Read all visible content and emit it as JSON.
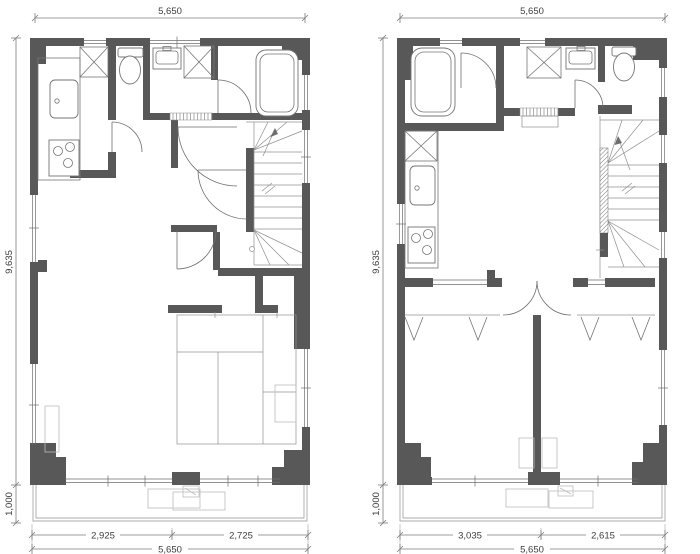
{
  "page": {
    "title": "floor-plan-drawing"
  },
  "colors": {
    "wall": "#585858",
    "line": "#6e6e6e",
    "dimension_text": "#3d3d3d",
    "background": "#ffffff"
  },
  "plans": [
    {
      "name": "left-floor-plan",
      "dimensions": {
        "top_width": "5,650",
        "height": "9,635",
        "balcony_depth": "1,000",
        "bottom_segment_1": "2,925",
        "bottom_segment_2": "2,725",
        "bottom_total": "5,650"
      },
      "features": [
        "kitchen-sink",
        "stove",
        "washer-space",
        "toilet",
        "washbasin",
        "bathtub",
        "staircase",
        "tatami-room",
        "balcony"
      ]
    },
    {
      "name": "right-floor-plan",
      "dimensions": {
        "top_width": "5,650",
        "height": "9,635",
        "balcony_depth": "1,000",
        "bottom_segment_1": "3,035",
        "bottom_segment_2": "2,615",
        "bottom_total": "5,650"
      },
      "features": [
        "bathtub",
        "washer-space",
        "washbasin",
        "toilet",
        "kitchen-sink",
        "stove",
        "staircase",
        "two-bedrooms",
        "closet-hangers",
        "balcony"
      ]
    }
  ]
}
